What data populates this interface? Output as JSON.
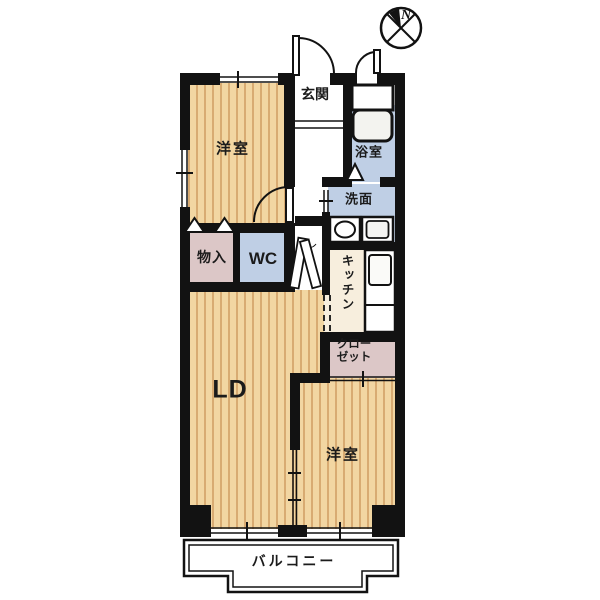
{
  "plan": {
    "type": "apartment-floor-plan",
    "compass": {
      "north_label": "N"
    },
    "rooms": {
      "bedroom_top": "洋室",
      "entrance": "玄関",
      "bathroom": "浴室",
      "washroom": "洗面",
      "storage": "物入",
      "toilet": "WC",
      "kitchen": "キッチン",
      "living_dining": "LD",
      "closet_line1": "クロー",
      "closet_line2": "ゼット",
      "bedroom_bottom": "洋室",
      "balcony": "バルコニー"
    },
    "colors": {
      "wall": "#121212",
      "wood_floor": "#f2d6a2",
      "wood_stripe": "#d8ab72",
      "wet_area_blue": "#bfcfe5",
      "storage_pink": "#dcc7c7",
      "kitchen_cream": "#f7eedd"
    }
  }
}
